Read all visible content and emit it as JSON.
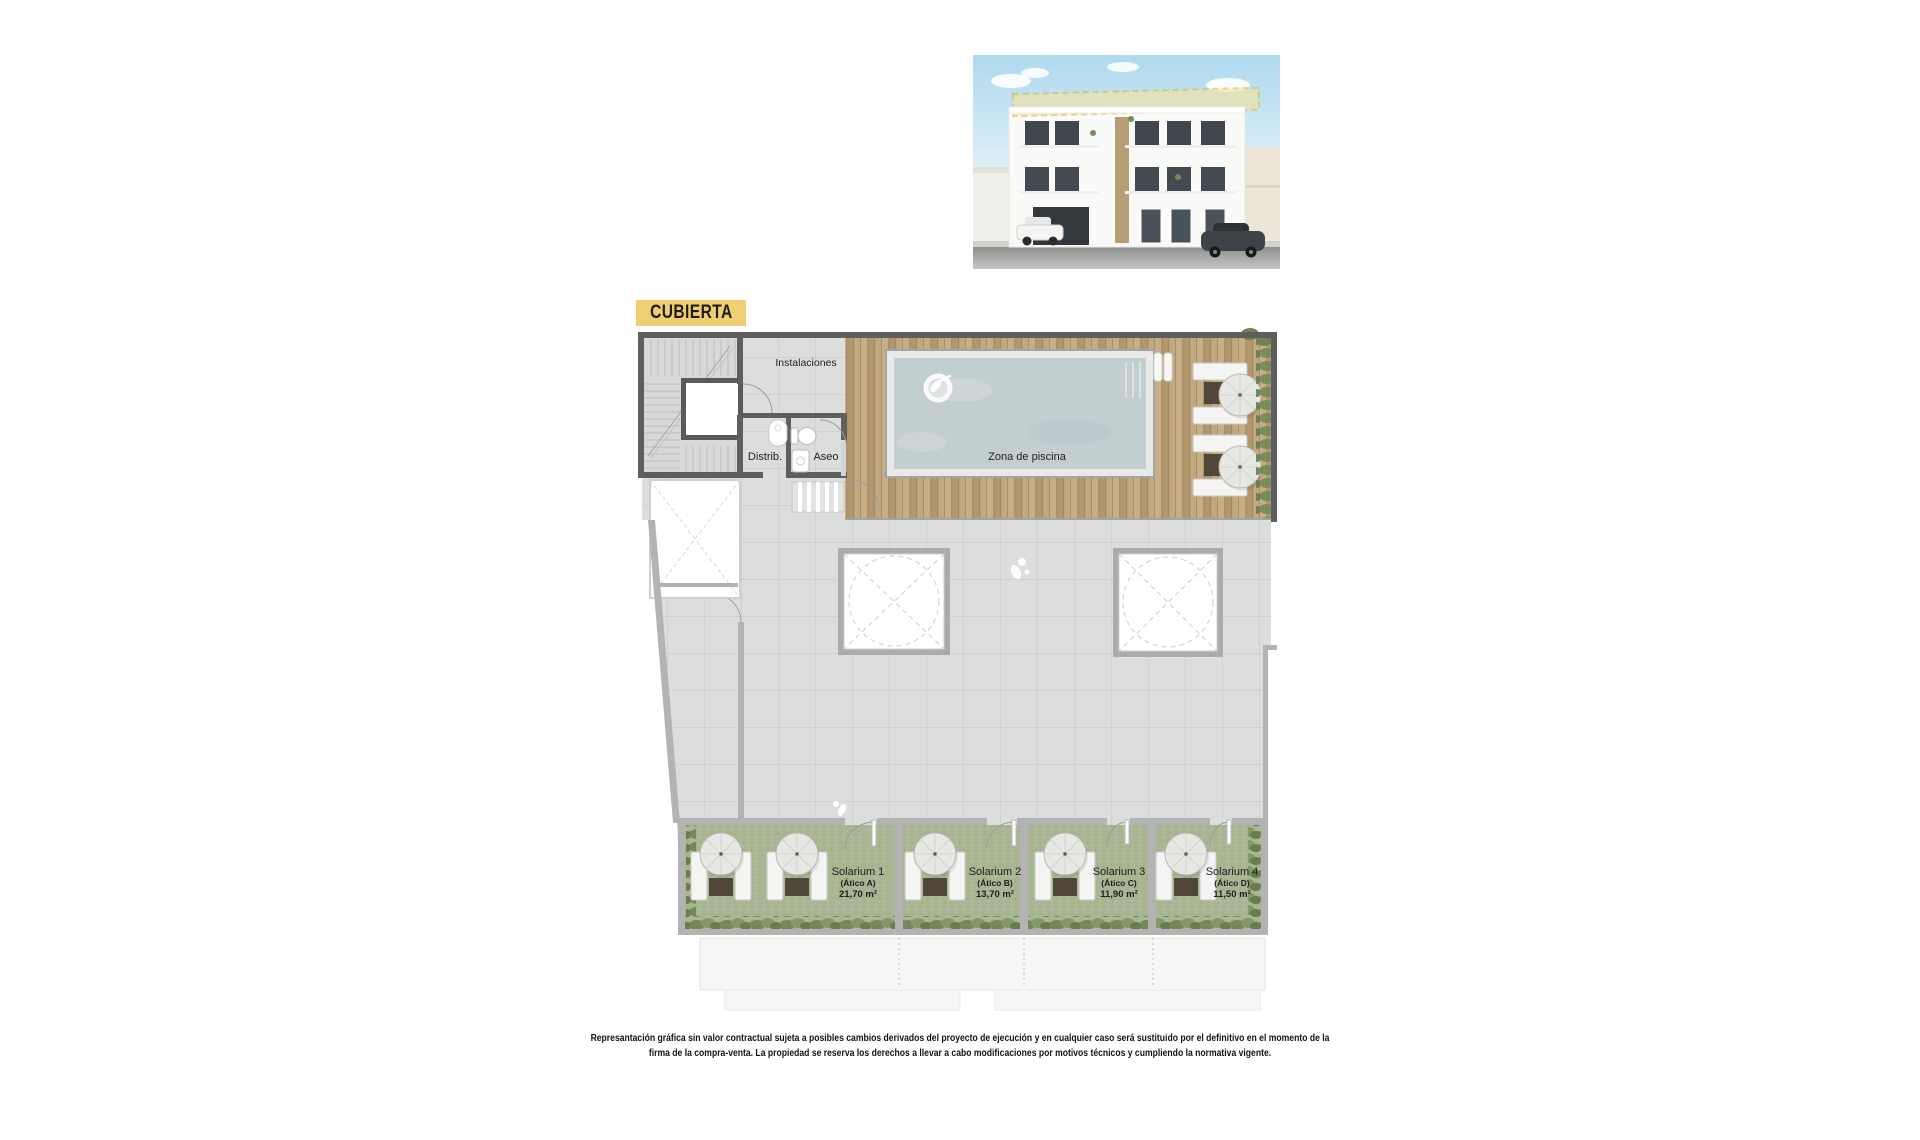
{
  "badge": {
    "label": "CUBIERTA"
  },
  "plan": {
    "labels": {
      "instalaciones": "Instalaciones",
      "distrib": "Distrib.",
      "aseo": "Aseo",
      "pool_zone": "Zona de piscina"
    },
    "solariums": [
      {
        "name": "Solarium 1",
        "unit": "(Ático A)",
        "area": "21,70 m²"
      },
      {
        "name": "Solarium 2",
        "unit": "(Ático B)",
        "area": "13,70 m²"
      },
      {
        "name": "Solarium 3",
        "unit": "(Ático C)",
        "area": "11,90 m²"
      },
      {
        "name": "Solarium 4",
        "unit": "(Ático D)",
        "area": "11,50 m²"
      }
    ]
  },
  "disclaimer": {
    "line1": "Represantación gráfica sin valor contractual sujeta a posibles cambios derivados del proyecto de ejecución y en cualquier caso será sustituido por el definitivo en el momento de la",
    "line2": "firma de la compra-venta. La propiedad se reserva los derechos a llevar a cabo modificaciones por motivos técnicos y cumpliendo la normativa vigente."
  },
  "colors": {
    "badge_bg": "#F0CF72",
    "wall_dark": "#5E5E5E",
    "wall_light": "#B3B3B3",
    "tile": "#DCDEDB",
    "wood": "#BEA478",
    "water": "#C3CED1",
    "turf": "#A9B694"
  }
}
